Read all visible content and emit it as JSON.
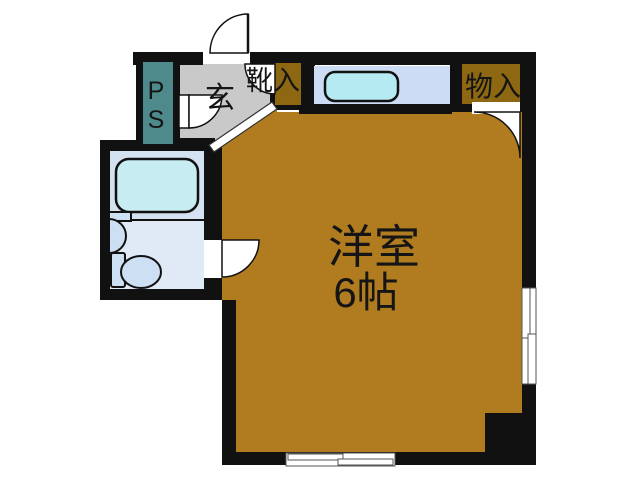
{
  "floorplan": {
    "labels": {
      "main_room": "洋室",
      "main_room_size": "6帖",
      "entrance": "玄",
      "shoe_storage": "靴入",
      "storage": "物入",
      "pipe_space_l1": "P",
      "pipe_space_l2": "S"
    },
    "colors": {
      "wall": "#111111",
      "line": "#111111",
      "room_floor": "#b17c20",
      "genkan_floor": "#c9c9c9",
      "storage_fill": "#8d6712",
      "ps_fill": "#4e898b",
      "kitchen_floor": "#ccdcf4",
      "bath_upper": "#d3e1f0",
      "bath_lower": "#dfeaf6",
      "bathtub_fill": "#c7edf3",
      "fixture_fill": "#cddff2",
      "sink_fill": "#b6eaf3"
    }
  }
}
